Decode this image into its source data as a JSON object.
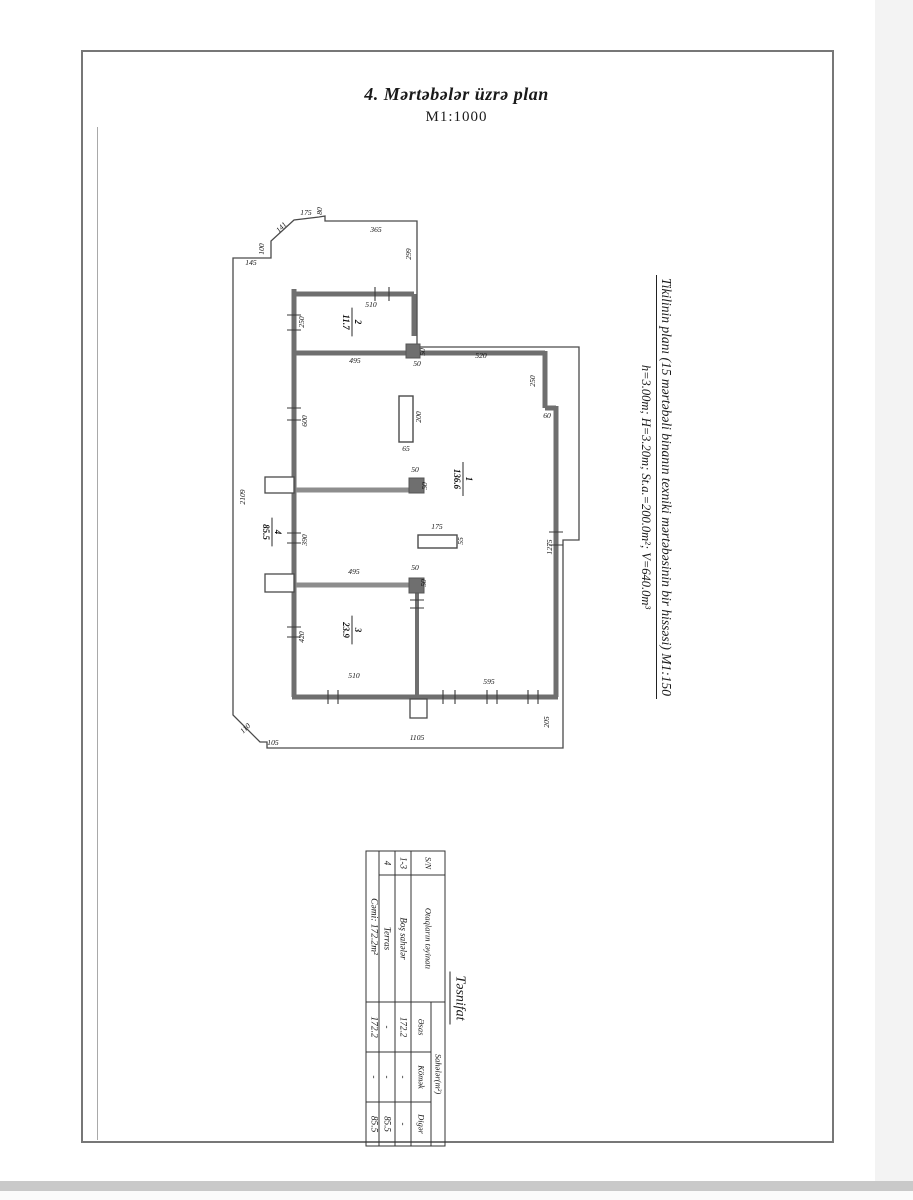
{
  "page": {
    "title": "4. Mərtəbələr üzrə plan",
    "scale": "M1:1000"
  },
  "caption": {
    "line1": "Tikilinin planı (15 mərtəbəli binanın texniki mərtəbəsinin bir hissəsi) M1:150",
    "line2": "h=3.00m; H=3.20m; St.a.=200.0m²; V=640.0m³"
  },
  "plan": {
    "rooms": [
      {
        "num": "2",
        "area": "11.7",
        "x": 352,
        "y": 322
      },
      {
        "num": "1",
        "area": "136.6",
        "x": 463,
        "y": 479
      },
      {
        "num": "3",
        "area": "23.9",
        "x": 352,
        "y": 630
      },
      {
        "num": "4",
        "area": "85.5",
        "x": 272,
        "y": 532
      }
    ],
    "dims": [
      {
        "t": "365",
        "x": 376,
        "y": 232,
        "r": 0
      },
      {
        "t": "175",
        "x": 306,
        "y": 215,
        "r": 0
      },
      {
        "t": "80",
        "x": 322,
        "y": 211,
        "r": -90
      },
      {
        "t": "141",
        "x": 283,
        "y": 229,
        "r": -45
      },
      {
        "t": "100",
        "x": 264,
        "y": 249,
        "r": -90
      },
      {
        "t": "145",
        "x": 251,
        "y": 265,
        "r": 0
      },
      {
        "t": "299",
        "x": 411,
        "y": 254,
        "r": -90
      },
      {
        "t": "510",
        "x": 371,
        "y": 307,
        "r": 0
      },
      {
        "t": "250",
        "x": 304,
        "y": 322,
        "r": -90
      },
      {
        "t": "495",
        "x": 355,
        "y": 363,
        "r": 0
      },
      {
        "t": "50",
        "x": 417,
        "y": 366,
        "r": 0
      },
      {
        "t": "50",
        "x": 425,
        "y": 352,
        "r": -90
      },
      {
        "t": "520",
        "x": 481,
        "y": 358,
        "r": 0
      },
      {
        "t": "250",
        "x": 535,
        "y": 381,
        "r": -90
      },
      {
        "t": "60",
        "x": 547,
        "y": 418,
        "r": 0
      },
      {
        "t": "200",
        "x": 421,
        "y": 417,
        "r": -90
      },
      {
        "t": "65",
        "x": 406,
        "y": 451,
        "r": 0
      },
      {
        "t": "600",
        "x": 307,
        "y": 421,
        "r": -90
      },
      {
        "t": "2109",
        "x": 245,
        "y": 497,
        "r": -90
      },
      {
        "t": "50",
        "x": 415,
        "y": 472,
        "r": 0
      },
      {
        "t": "50",
        "x": 427,
        "y": 486,
        "r": -90
      },
      {
        "t": "390",
        "x": 307,
        "y": 540,
        "r": -90
      },
      {
        "t": "175",
        "x": 437,
        "y": 529,
        "r": 0
      },
      {
        "t": "55",
        "x": 463,
        "y": 541,
        "r": -90
      },
      {
        "t": "495",
        "x": 354,
        "y": 574,
        "r": 0
      },
      {
        "t": "50",
        "x": 415,
        "y": 570,
        "r": 0
      },
      {
        "t": "50",
        "x": 426,
        "y": 583,
        "r": -90
      },
      {
        "t": "1275",
        "x": 552,
        "y": 547,
        "r": -90
      },
      {
        "t": "420",
        "x": 304,
        "y": 637,
        "r": -90
      },
      {
        "t": "510",
        "x": 354,
        "y": 678,
        "r": 0
      },
      {
        "t": "595",
        "x": 489,
        "y": 684,
        "r": 0
      },
      {
        "t": "205",
        "x": 549,
        "y": 722,
        "r": -90
      },
      {
        "t": "1105",
        "x": 417,
        "y": 740,
        "r": 0
      },
      {
        "t": "105",
        "x": 273,
        "y": 745,
        "r": 0
      },
      {
        "t": "110",
        "x": 247,
        "y": 730,
        "r": -45
      }
    ]
  },
  "table": {
    "title": "Təsnifat",
    "headers": {
      "sn": "S/N",
      "purpose": "Otaqların təyinatı",
      "areas": "Sahələr(m²)",
      "sub": [
        "Əsas",
        "Kömək",
        "Digər"
      ]
    },
    "rows": [
      {
        "sn": "1-3",
        "purpose": "Boş sahələr",
        "main": "172.2",
        "aux": "-",
        "other": "-"
      },
      {
        "sn": "4",
        "purpose": "Terras",
        "main": "-",
        "aux": "-",
        "other": "85.5"
      }
    ],
    "total": {
      "label": "Cəmi:  172.2m²",
      "main": "172.2",
      "aux": "-",
      "other": "85.5"
    }
  }
}
